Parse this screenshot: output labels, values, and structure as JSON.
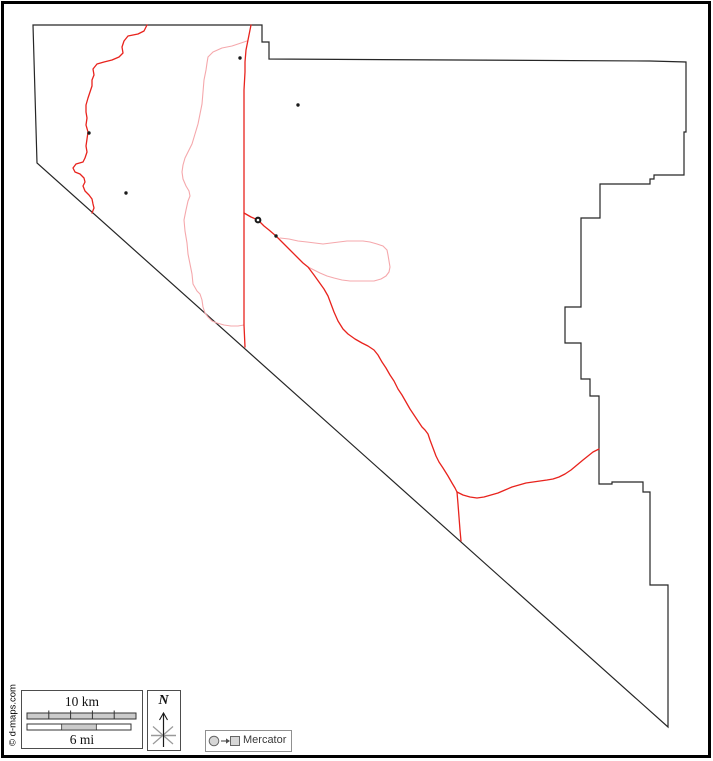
{
  "meta": {
    "width": 713,
    "height": 761,
    "background_color": "#ffffff",
    "frame_color": "#000000"
  },
  "map": {
    "county_outline": {
      "color": "#262626",
      "stroke_width": 1.2,
      "closed": true,
      "points": [
        [
          33,
          25
        ],
        [
          262,
          25
        ],
        [
          262,
          42
        ],
        [
          269,
          42
        ],
        [
          269,
          59
        ],
        [
          650,
          61
        ],
        [
          686,
          62
        ],
        [
          686,
          132
        ],
        [
          684,
          132
        ],
        [
          684,
          175
        ],
        [
          654,
          175
        ],
        [
          654,
          179
        ],
        [
          650,
          179
        ],
        [
          650,
          184
        ],
        [
          600,
          184
        ],
        [
          600,
          218
        ],
        [
          581,
          218
        ],
        [
          581,
          307
        ],
        [
          565,
          307
        ],
        [
          565,
          343
        ],
        [
          581,
          343
        ],
        [
          581,
          379
        ],
        [
          590,
          379
        ],
        [
          590,
          396
        ],
        [
          599,
          396
        ],
        [
          599,
          484
        ],
        [
          612,
          484
        ],
        [
          612,
          482
        ],
        [
          643,
          482
        ],
        [
          643,
          492
        ],
        [
          650,
          492
        ],
        [
          650,
          585
        ],
        [
          668,
          585
        ],
        [
          668,
          727
        ],
        [
          37,
          163
        ]
      ]
    },
    "rivers": {
      "color": "#f5a8ac",
      "stroke_width": 1.1,
      "paths": [
        {
          "name": "west-river",
          "points": [
            [
              247,
              41
            ],
            [
              241,
              43
            ],
            [
              232,
              46
            ],
            [
              222,
              48
            ],
            [
              213,
              52
            ],
            [
              208,
              57
            ],
            [
              207,
              63
            ],
            [
              206,
              70
            ],
            [
              204,
              80
            ],
            [
              203,
              92
            ],
            [
              202,
              104
            ],
            [
              200,
              114
            ],
            [
              198,
              124
            ],
            [
              195,
              134
            ],
            [
              192,
              144
            ],
            [
              188,
              152
            ],
            [
              185,
              158
            ],
            [
              183,
              165
            ],
            [
              182,
              172
            ],
            [
              183,
              179
            ],
            [
              186,
              186
            ],
            [
              189,
              191
            ],
            [
              190,
              196
            ],
            [
              188,
              201
            ],
            [
              186,
              210
            ],
            [
              184,
              220
            ],
            [
              185,
              231
            ],
            [
              187,
              243
            ],
            [
              188,
              254
            ],
            [
              190,
              264
            ],
            [
              192,
              274
            ],
            [
              193,
              284
            ],
            [
              197,
              291
            ],
            [
              200,
              294
            ],
            [
              202,
              300
            ],
            [
              203,
              307
            ],
            [
              205,
              313
            ],
            [
              208,
              317
            ],
            [
              212,
              321
            ],
            [
              217,
              323
            ],
            [
              224,
              325
            ],
            [
              231,
              326
            ],
            [
              238,
              326
            ],
            [
              244,
              325
            ]
          ]
        },
        {
          "name": "east-loop-river",
          "points": [
            [
              280,
              238
            ],
            [
              289,
              239
            ],
            [
              298,
              241
            ],
            [
              307,
              242
            ],
            [
              315,
              243
            ],
            [
              323,
              244
            ],
            [
              331,
              243
            ],
            [
              339,
              242
            ],
            [
              347,
              241
            ],
            [
              355,
              241
            ],
            [
              363,
              241
            ],
            [
              370,
              242
            ],
            [
              377,
              244
            ],
            [
              383,
              246
            ],
            [
              387,
              250
            ],
            [
              388,
              255
            ],
            [
              389,
              261
            ],
            [
              390,
              267
            ],
            [
              389,
              272
            ],
            [
              386,
              276
            ],
            [
              381,
              279
            ],
            [
              374,
              281
            ],
            [
              366,
              281
            ],
            [
              358,
              281
            ],
            [
              350,
              281
            ],
            [
              342,
              280
            ],
            [
              334,
              278
            ],
            [
              327,
              276
            ],
            [
              320,
              273
            ],
            [
              314,
              270
            ],
            [
              310,
              268
            ],
            [
              308,
              267
            ]
          ]
        }
      ]
    },
    "roads": {
      "color": "#e8231d",
      "stroke_width": 1.3,
      "paths": [
        {
          "name": "west-wavy-road",
          "points": [
            [
              147,
              25
            ],
            [
              144,
              31
            ],
            [
              138,
              34
            ],
            [
              128,
              36
            ],
            [
              124,
              41
            ],
            [
              122,
              47
            ],
            [
              123,
              53
            ],
            [
              119,
              57
            ],
            [
              112,
              60
            ],
            [
              104,
              62
            ],
            [
              97,
              64
            ],
            [
              93,
              69
            ],
            [
              94,
              75
            ],
            [
              92,
              80
            ],
            [
              92,
              86
            ],
            [
              90,
              92
            ],
            [
              88,
              98
            ],
            [
              86,
              105
            ],
            [
              86,
              112
            ],
            [
              87,
              118
            ],
            [
              86,
              125
            ],
            [
              88,
              132
            ],
            [
              87,
              139
            ],
            [
              86,
              146
            ],
            [
              87,
              152
            ],
            [
              85,
              158
            ],
            [
              83,
              162
            ],
            [
              76,
              164
            ],
            [
              73,
              168
            ],
            [
              75,
              172
            ],
            [
              80,
              174
            ],
            [
              84,
              178
            ],
            [
              85,
              182
            ],
            [
              83,
              186
            ],
            [
              85,
              191
            ],
            [
              89,
              195
            ],
            [
              92,
              199
            ],
            [
              93,
              204
            ],
            [
              94,
              208
            ],
            [
              92,
              213
            ]
          ]
        },
        {
          "name": "north-south-road",
          "points": [
            [
              251,
              25
            ],
            [
              249,
              35
            ],
            [
              246,
              50
            ],
            [
              245,
              62
            ],
            [
              245,
              72
            ],
            [
              244,
              90
            ],
            [
              244,
              120
            ],
            [
              244,
              150
            ],
            [
              244,
              180
            ],
            [
              244,
              213
            ],
            [
              244,
              250
            ],
            [
              244,
              290
            ],
            [
              244,
              325
            ],
            [
              245,
              347
            ]
          ]
        },
        {
          "name": "southeast-road",
          "points": [
            [
              244,
              213
            ],
            [
              251,
              217
            ],
            [
              258,
              220
            ],
            [
              264,
              226
            ],
            [
              269,
              230
            ],
            [
              276,
              236
            ],
            [
              283,
              243
            ],
            [
              290,
              250
            ],
            [
              297,
              257
            ],
            [
              303,
              263
            ],
            [
              308,
              267
            ],
            [
              314,
              275
            ],
            [
              319,
              282
            ],
            [
              324,
              289
            ],
            [
              328,
              296
            ],
            [
              331,
              304
            ],
            [
              334,
              312
            ],
            [
              338,
              321
            ],
            [
              343,
              329
            ],
            [
              348,
              334
            ],
            [
              355,
              339
            ],
            [
              362,
              343
            ],
            [
              368,
              346
            ],
            [
              374,
              350
            ],
            [
              378,
              355
            ],
            [
              382,
              362
            ],
            [
              386,
              368
            ],
            [
              390,
              375
            ],
            [
              394,
              381
            ],
            [
              398,
              389
            ],
            [
              402,
              395
            ],
            [
              406,
              402
            ],
            [
              410,
              409
            ],
            [
              414,
              415
            ],
            [
              418,
              421
            ],
            [
              422,
              427
            ],
            [
              425,
              430
            ],
            [
              428,
              434
            ],
            [
              430,
              440
            ],
            [
              433,
              448
            ],
            [
              436,
              456
            ],
            [
              439,
              462
            ],
            [
              443,
              468
            ],
            [
              448,
              476
            ],
            [
              452,
              483
            ],
            [
              455,
              488
            ],
            [
              457,
              492
            ]
          ]
        },
        {
          "name": "east-branch-road",
          "points": [
            [
              457,
              492
            ],
            [
              463,
              495
            ],
            [
              470,
              497
            ],
            [
              477,
              498
            ],
            [
              484,
              497
            ],
            [
              491,
              495
            ],
            [
              498,
              493
            ],
            [
              505,
              490
            ],
            [
              512,
              487
            ],
            [
              519,
              485
            ],
            [
              526,
              483
            ],
            [
              533,
              482
            ],
            [
              540,
              481
            ],
            [
              547,
              480
            ],
            [
              553,
              479
            ],
            [
              559,
              477
            ],
            [
              565,
              474
            ],
            [
              571,
              470
            ],
            [
              577,
              465
            ],
            [
              583,
              460
            ],
            [
              588,
              456
            ],
            [
              593,
              452
            ],
            [
              599,
              449
            ]
          ]
        },
        {
          "name": "south-branch-road",
          "points": [
            [
              457,
              492
            ],
            [
              458,
              504
            ],
            [
              459,
              517
            ],
            [
              460,
              530
            ],
            [
              461,
              541
            ]
          ]
        }
      ]
    },
    "towns": {
      "color": "#1a1a1a",
      "dot_radius": 1.7,
      "dots": [
        [
          240,
          58
        ],
        [
          298,
          105
        ],
        [
          89,
          133
        ],
        [
          126,
          193
        ],
        [
          276,
          236
        ]
      ]
    },
    "county_seat": {
      "x": 258,
      "y": 220,
      "outer_radius": 3.4,
      "ring_width": 2.1,
      "color": "#1a1a1a"
    }
  },
  "scale_bar": {
    "km_label": "10 km",
    "mi_label": "6 mi",
    "box": {
      "x": 21.5,
      "y": 690.5,
      "w": 121,
      "h": 58,
      "border_color": "#4d4d4d"
    },
    "km_bar": {
      "x": 27,
      "y": 713,
      "w": 109,
      "h": 6,
      "divisions": 5,
      "fill": "#cbcbcb",
      "border_color": "#333333"
    },
    "mi_bar": {
      "x": 27,
      "y": 724,
      "w": 104,
      "h": 6,
      "segments": 3,
      "filled_segment": 1,
      "fill": "#cbcbcb",
      "border_color": "#333333"
    }
  },
  "north_arrow": {
    "label": "N",
    "box": {
      "x": 147.5,
      "y": 690.5,
      "w": 33,
      "h": 60,
      "border_color": "#4d4d4d"
    },
    "cx": 163.5,
    "star_cy": 735.5,
    "shaft_top": 713,
    "shaft_bottom": 747,
    "arrow_color": "#1a1a1a",
    "star_color": "#999999"
  },
  "projection_legend": {
    "label": "Mercator",
    "box": {
      "x": 205.5,
      "y": 730.5,
      "w": 86,
      "h": 21,
      "border_color": "#909090"
    },
    "glyph_fill": "#d6d6d6",
    "glyph_stroke": "#666666",
    "arrow_color": "#4d4d4d"
  },
  "copyright": {
    "text": "© d-maps.com"
  }
}
